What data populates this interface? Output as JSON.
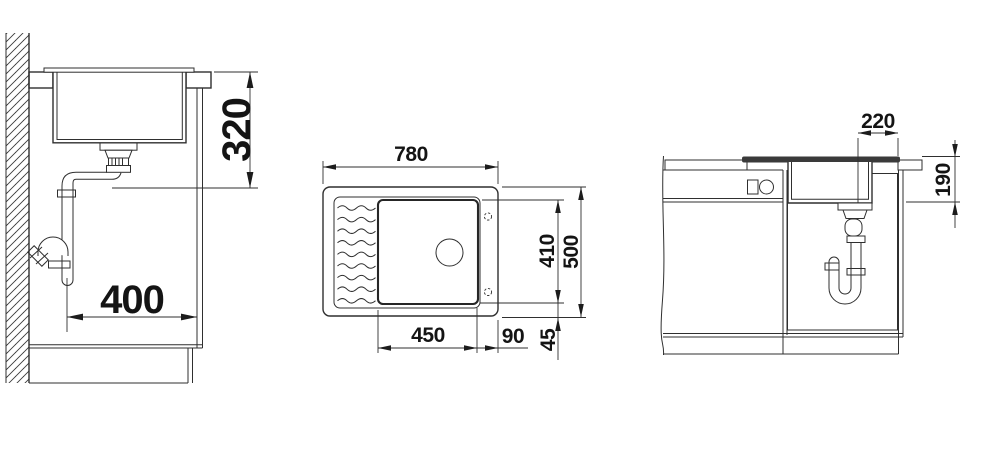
{
  "colors": {
    "background": "#ffffff",
    "line": "#2f2f2f",
    "text": "#141414",
    "rim_fill": "#3a3a3a"
  },
  "views": {
    "side": {
      "dims": {
        "height": "320",
        "reach": "400"
      }
    },
    "top": {
      "dims": {
        "width": "780",
        "depth": "500",
        "bowl_width": "450",
        "bowl_depth": "410",
        "right_section": "90",
        "rear_section": "45"
      }
    },
    "front": {
      "dims": {
        "drain_offset": "220",
        "bowl_height": "190"
      }
    }
  }
}
